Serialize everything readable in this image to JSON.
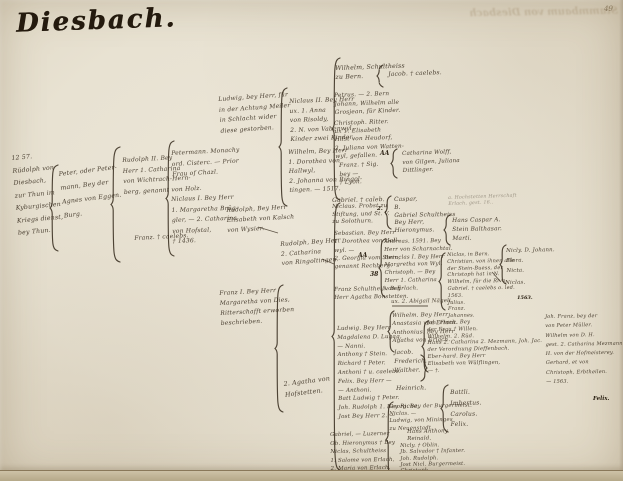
{
  "page": {
    "title": "Diesbach.",
    "page_number": "49",
    "bleed_text": "Stammbaum von Diesbach",
    "ink_color": "#33281a",
    "paper_color": "#e8e2d2"
  },
  "tree": {
    "nodes": [
      {
        "id": "root-rudolph-1257",
        "x": 11,
        "y": 153,
        "fs": 6.2,
        "lh": 12.5,
        "rot": -5,
        "faint": false,
        "lines": [
          "12 57.",
          "Rüdolph von",
          "Diesbach,",
          "zur Thun im",
          "Kyburgischen",
          "Kriegs dienst,",
          "bey Thun."
        ]
      },
      {
        "id": "peter-petermann",
        "x": 58,
        "y": 168,
        "fs": 6.2,
        "lh": 14,
        "rot": -7,
        "faint": false,
        "lines": [
          "Peter, oder Peter-",
          "mann, Bey der",
          "Agnes von Eggen.",
          "Burg."
        ]
      },
      {
        "id": "rudolph-ii",
        "x": 122,
        "y": 156,
        "fs": 6,
        "lh": 10.5,
        "rot": -3,
        "faint": false,
        "lines": [
          "Rudolph II. Bey",
          "Herr 1. Catharina",
          "von Wichtrach-Hern-",
          "berg, genannt von Holz."
        ]
      },
      {
        "id": "franz-caelebs",
        "x": 134,
        "y": 234,
        "fs": 6,
        "lh": 10,
        "rot": -3,
        "faint": false,
        "lines": [
          "Franz. † caelebs."
        ]
      },
      {
        "id": "petermann-monachy",
        "x": 171,
        "y": 149,
        "fs": 6,
        "lh": 10.5,
        "rot": -3,
        "faint": false,
        "lines": [
          "Petermann. Monachy",
          "ord. Cisterc. — Prior",
          "Frau of Chazl."
        ]
      },
      {
        "id": "niclaus-i",
        "x": 171,
        "y": 195,
        "fs": 6,
        "lh": 10.5,
        "rot": -2,
        "faint": false,
        "lines": [
          "Niclaus I. Bey Herr",
          "1. Margaretha Brüg-",
          "gler, — 2. Catharina",
          "von Hofstal,",
          "† 1436."
        ]
      },
      {
        "id": "ludwig-schlacht",
        "x": 218,
        "y": 95,
        "fs": 6,
        "lh": 10.5,
        "rot": -4,
        "faint": false,
        "lines": [
          "Ludwig, bey Herr, für",
          "in der Achtung Meiler",
          "in Schlacht wider",
          "diese gestorben."
        ]
      },
      {
        "id": "rudolph-kalsch",
        "x": 226,
        "y": 206,
        "fs": 6,
        "lh": 10,
        "rot": -3,
        "faint": false,
        "lines": [
          "Rudolph, Bey Herr",
          "Elisabeth von Kalsch",
          "von Wysier."
        ]
      },
      {
        "id": "franz-i-ritter",
        "x": 219,
        "y": 289,
        "fs": 6,
        "lh": 10,
        "rot": -3,
        "faint": false,
        "lines": [
          "Franz I. Bey Herr",
          "Margaretha von Dies,",
          "Ritterschafft erworben",
          "beschrieben."
        ]
      },
      {
        "id": "rudolph-ringoltingen",
        "x": 280,
        "y": 240,
        "fs": 6,
        "lh": 9.5,
        "rot": -4,
        "faint": false,
        "lines": [
          "Rudolph, Bey Herr",
          "2. Catharina",
          "von Ringoltingen."
        ]
      },
      {
        "id": "agatha-hofstetten",
        "x": 283,
        "y": 379,
        "fs": 6.3,
        "lh": 11,
        "rot": -7,
        "faint": false,
        "lines": [
          "2. Agatha von",
          "Hofstetten."
        ]
      },
      {
        "id": "niclaus-ii",
        "x": 289,
        "y": 97,
        "fs": 6,
        "lh": 9.5,
        "rot": -2,
        "faint": false,
        "lines": [
          "Niclaus II. Bey Herr",
          "ux. 1. Anna",
          "von Risoldy,",
          "2. N. von Vabenwyl,",
          "Kinder zwei Kinder."
        ]
      },
      {
        "id": "wilhelm-hallwyl",
        "x": 288,
        "y": 148,
        "fs": 6,
        "lh": 9.5,
        "rot": -2,
        "faint": false,
        "lines": [
          "Wilhelm, Bey Herr",
          "1. Dorothea von",
          "Hallwyl,",
          "2. Johanna von Ringol-",
          "tingen. — 1517."
        ]
      },
      {
        "id": "wilhelm-schultheiss",
        "x": 335,
        "y": 64,
        "fs": 6.2,
        "lh": 9,
        "rot": -2,
        "faint": false,
        "lines": [
          "Wilhelm, Schultheiss",
          "zu Bern."
        ]
      },
      {
        "id": "jacob-caelebs",
        "x": 388,
        "y": 70,
        "fs": 6,
        "lh": 9,
        "rot": -2,
        "faint": false,
        "lines": [
          "Jacob. † caelebs."
        ]
      },
      {
        "id": "petrus-group",
        "x": 334,
        "y": 92,
        "fs": 5.8,
        "lh": 8.5,
        "rot": -2,
        "faint": false,
        "lines": [
          "Petrus. — 2. Bern",
          "Johann, Wilhelm alle",
          "Grosjean, für Kinder."
        ]
      },
      {
        "id": "christoph-ritter",
        "x": 334,
        "y": 120,
        "fs": 5.8,
        "lh": 8.2,
        "rot": -2,
        "faint": false,
        "lines": [
          "Christoph. Ritter.",
          "ux 1. Elisabeth",
          "Hilst von Heudorf,",
          "2. Juliana von Watten-",
          "wyl, gefallen."
        ]
      },
      {
        "id": "franz-sig",
        "x": 339,
        "y": 162,
        "fs": 5.8,
        "lh": 8.5,
        "rot": -2,
        "faint": false,
        "lines": [
          "Franz. † Sig.",
          "bey —",
          "† Lyon."
        ]
      },
      {
        "id": "catharina-wolff",
        "x": 402,
        "y": 150,
        "fs": 5.6,
        "lh": 8.5,
        "rot": -2,
        "faint": false,
        "lines": [
          "Catharina Wolff,",
          "von Gilgen, Juliana",
          "Dittlinger."
        ]
      },
      {
        "id": "gabriel-caleb",
        "x": 332,
        "y": 196,
        "fs": 6,
        "lh": 9,
        "rot": -1,
        "faint": false,
        "lines": [
          "Gabriel. † caleb."
        ]
      },
      {
        "id": "caspar-group",
        "x": 394,
        "y": 197,
        "fs": 5.8,
        "lh": 7.8,
        "rot": -1,
        "faint": false,
        "lines": [
          "Caspar,",
          "B.",
          "Gabriel Schultheiss",
          "Bey Herr,",
          "Hieronymus."
        ]
      },
      {
        "id": "niclaus-probst",
        "x": 332,
        "y": 204,
        "fs": 5.6,
        "lh": 7.5,
        "rot": -1,
        "faint": false,
        "lines": [
          "Niclaus. Probst zu",
          "Stiftung, und St. V.",
          "zu Solothurn."
        ]
      },
      {
        "id": "sebastian",
        "x": 334,
        "y": 230,
        "fs": 5.6,
        "lh": 8.3,
        "rot": -1,
        "faint": false,
        "lines": [
          "Sebastian. Bey Herr",
          "1. Dorothea von Hall-",
          "wyl. —",
          "2. Georgia vom Stein,",
          "genannt Rechberg."
        ]
      },
      {
        "id": "franz-schultheiss",
        "x": 334,
        "y": 286,
        "fs": 5.6,
        "lh": 8.3,
        "rot": -1,
        "faint": false,
        "lines": [
          "Franz Schultheiß. Bey",
          "Herr Agatha Bonstetten."
        ]
      },
      {
        "id": "andreas-group",
        "x": 384,
        "y": 239,
        "fs": 5.4,
        "lh": 7.8,
        "rot": -1,
        "faint": false,
        "lines": [
          "Andreas. 1591. Bey",
          "Herr von Scharnachtal.",
          "Bernclas I. Bey Herr",
          "Margretha von Wyl.",
          "Christoph. — Bey",
          "Herr 1. Catharina",
          "von Erlach."
        ]
      },
      {
        "id": "abigail-naegeli",
        "x": 391,
        "y": 299,
        "fs": 5.4,
        "lh": 7,
        "rot": -1,
        "faint": false,
        "lines": [
          "ux. 2. Abigail Nägeli."
        ]
      },
      {
        "id": "ludwig-group",
        "x": 337,
        "y": 325,
        "fs": 5.6,
        "lh": 8.8,
        "rot": -1,
        "faint": false,
        "lines": [
          "Ludwig. Bey Herr",
          "Magdalena D. Lugag,",
          "— Nanni.",
          "Anthony † Stein.",
          "Richard † Peter.",
          "Anthoni † u. caelebs.",
          "Felix. Bey Herr —",
          "— Anthoni.",
          "Batt Ludwig † Peter.",
          "Joh. Rudolph 1. Bey Richa,",
          "Jost Bey Herr 2. —"
        ]
      },
      {
        "id": "wilhelm-erlach",
        "x": 392,
        "y": 312,
        "fs": 5.6,
        "lh": 8.3,
        "rot": -1,
        "faint": false,
        "lines": [
          "Wilhelm. Bey Herr",
          "Anastasia von Erlach.",
          "Anthonius. Bey Herr",
          "Agatha von Erlach."
        ]
      },
      {
        "id": "jacob-frederich-walther",
        "x": 394,
        "y": 349,
        "fs": 5.8,
        "lh": 8.8,
        "rot": -1,
        "faint": false,
        "lines": [
          "Jacob.",
          "Frederich.",
          "Walther."
        ]
      },
      {
        "id": "heinrich",
        "x": 396,
        "y": 384,
        "fs": 6,
        "lh": 9,
        "rot": -1,
        "faint": false,
        "lines": [
          "Heinrich."
        ]
      },
      {
        "id": "gabriel-luzern-group",
        "x": 330,
        "y": 431,
        "fs": 5.4,
        "lh": 8.6,
        "rot": -1,
        "faint": false,
        "lines": [
          "Gabriel, — Luzerner",
          "Ob. Hieronymus † Bey",
          "Niclas, Schultheiss",
          "1. Salome von Erlach,",
          "2. Maria von Erlach."
        ]
      },
      {
        "id": "georg-group",
        "x": 389,
        "y": 404,
        "fs": 5.3,
        "lh": 7.2,
        "rot": -1,
        "faint": false,
        "lines": [
          "Georg. Bey der Burgermeist.",
          "Niclas. —",
          "Ludwig, von Mininges",
          "zu Neuenstadt."
        ]
      },
      {
        "id": "hans-anthony",
        "x": 407,
        "y": 429,
        "fs": 5.4,
        "lh": 6.8,
        "rot": -1,
        "faint": false,
        "lines": [
          "Hans Anthony.",
          "Reinald."
        ]
      },
      {
        "id": "nicly-oblin-group",
        "x": 400,
        "y": 443,
        "fs": 5.2,
        "lh": 6.3,
        "rot": -1,
        "faint": false,
        "lines": [
          "Nicly. † Oblin.",
          "Jb. Salvador † Infanter.",
          "Joh. Rudolph.",
          "Jost Nicl. Burgermeist.",
          "Christoph.",
          "† Gerhard."
        ]
      },
      {
        "id": "joh-franz-group",
        "x": 427,
        "y": 320,
        "fs": 5.2,
        "lh": 6.8,
        "rot": -1,
        "faint": false,
        "lines": [
          "Joh. Franz. Bey",
          "der Frau † Willen.",
          "Wilhelm. 2. Rüd.",
          "Hans 2. Catharina 2. Mezmann, Joh. Jac.",
          "der Verordnung Dieffenbach.",
          "Eber-hard. Bey Herr",
          "Elisabeth von Wülflingen,",
          "— †."
        ]
      },
      {
        "id": "battli-group",
        "x": 450,
        "y": 388,
        "fs": 6,
        "lh": 10.8,
        "rot": -1,
        "faint": false,
        "lines": [
          "Battli.",
          "Imbertus.",
          "Carolus.",
          "Felix."
        ]
      },
      {
        "id": "hochstetten-faint",
        "x": 448,
        "y": 196,
        "fs": 4.8,
        "lh": 6,
        "rot": -2,
        "faint": true,
        "lines": [
          "a. Hochstetten Herrschaft",
          "Erlach, gest. 16.."
        ]
      },
      {
        "id": "hans-caspar",
        "x": 452,
        "y": 217,
        "fs": 5.8,
        "lh": 9,
        "rot": -1,
        "faint": false,
        "lines": [
          "Hans Caspar A.",
          "Stein Balthasar.",
          "Marti."
        ]
      },
      {
        "id": "niclas-bern-group",
        "x": 447,
        "y": 252,
        "fs": 5,
        "lh": 6.8,
        "rot": -1,
        "faint": false,
        "lines": [
          "Niclas, in Bern.",
          "Christian, von ihnen alle",
          "der Stein-Buess, der",
          "Christoph hat in N.",
          "Wilhelm, für die Riva,",
          "Gabriel. † caelebs o. led.",
          "1563.",
          "Julius.",
          "Franz.",
          "Johannes."
        ]
      },
      {
        "id": "nicly-johann",
        "x": 506,
        "y": 246,
        "fs": 5.4,
        "lh": 10,
        "rot": -1,
        "faint": false,
        "lines": [
          "Nicly. D. Johann.",
          "Flora.",
          "Nicta."
        ]
      },
      {
        "id": "niclas-below",
        "x": 505,
        "y": 279,
        "fs": 5.4,
        "lh": 9,
        "rot": -1,
        "faint": false,
        "lines": [
          "Niclas."
        ]
      },
      {
        "id": "far-right-group",
        "x": 545,
        "y": 313,
        "fs": 5,
        "lh": 9.3,
        "rot": -1,
        "faint": false,
        "lines": [
          "Joh. Franz, bey der",
          "von Peter Müller.",
          "Wilhelm von D. H.",
          "gest. 2. Catharina Mezmann für 8 Flor.",
          "H. von der Hofmeisterey.",
          "Gerhard, et von",
          "Christoph, Erbtheilen.",
          "— 1563."
        ]
      }
    ],
    "braces": [
      {
        "x": 50,
        "y1": 165,
        "y2": 251,
        "d": 8,
        "flip": false
      },
      {
        "x": 111,
        "y1": 147,
        "y2": 262,
        "d": 9,
        "flip": false
      },
      {
        "x": 166,
        "y1": 141,
        "y2": 256,
        "d": 8,
        "flip": false
      },
      {
        "x": 279,
        "y1": 88,
        "y2": 206,
        "d": 8,
        "flip": false
      },
      {
        "x": 275,
        "y1": 285,
        "y2": 412,
        "d": 8,
        "flip": false
      },
      {
        "x": 332,
        "y1": 58,
        "y2": 200,
        "d": 8,
        "flip": false
      },
      {
        "x": 332,
        "y1": 203,
        "y2": 470,
        "d": 8,
        "flip": false
      },
      {
        "x": 377,
        "y1": 65,
        "y2": 87,
        "d": 6,
        "flip": false
      },
      {
        "x": 391,
        "y1": 149,
        "y2": 178,
        "d": 6,
        "flip": false
      },
      {
        "x": 385,
        "y1": 196,
        "y2": 229,
        "d": 6,
        "flip": false
      },
      {
        "x": 379,
        "y1": 239,
        "y2": 297,
        "d": 6,
        "flip": false
      },
      {
        "x": 388,
        "y1": 311,
        "y2": 352,
        "d": 6,
        "flip": false
      },
      {
        "x": 421,
        "y1": 355,
        "y2": 381,
        "d": 6,
        "flip": true
      },
      {
        "x": 386,
        "y1": 402,
        "y2": 477,
        "d": 7,
        "flip": false
      },
      {
        "x": 422,
        "y1": 321,
        "y2": 372,
        "d": 6,
        "flip": false
      },
      {
        "x": 441,
        "y1": 385,
        "y2": 432,
        "d": 7,
        "flip": false
      },
      {
        "x": 444,
        "y1": 215,
        "y2": 245,
        "d": 6,
        "flip": false
      },
      {
        "x": 439,
        "y1": 253,
        "y2": 310,
        "d": 6,
        "flip": false
      },
      {
        "x": 500,
        "y1": 245,
        "y2": 284,
        "d": 6,
        "flip": false
      }
    ],
    "connectors": [
      {
        "x1": 258,
        "y1": 227,
        "x2": 278,
        "y2": 233
      },
      {
        "x1": 322,
        "y1": 259,
        "x2": 334,
        "y2": 264
      },
      {
        "x1": 392,
        "y1": 306,
        "x2": 428,
        "y2": 306
      },
      {
        "x1": 500,
        "y1": 281,
        "x2": 492,
        "y2": 272
      }
    ],
    "marks": [
      {
        "x": 380,
        "y": 150,
        "text": "AA",
        "fs": 6
      },
      {
        "x": 358,
        "y": 252,
        "text": "AA",
        "fs": 6
      },
      {
        "x": 370,
        "y": 271,
        "text": "38",
        "fs": 6
      },
      {
        "x": 377,
        "y": 206,
        "text": "2.",
        "fs": 5.5
      },
      {
        "x": 517,
        "y": 295,
        "text": "1563.",
        "fs": 5
      },
      {
        "x": 593,
        "y": 396,
        "text": "Felix.",
        "fs": 5.5
      }
    ]
  }
}
